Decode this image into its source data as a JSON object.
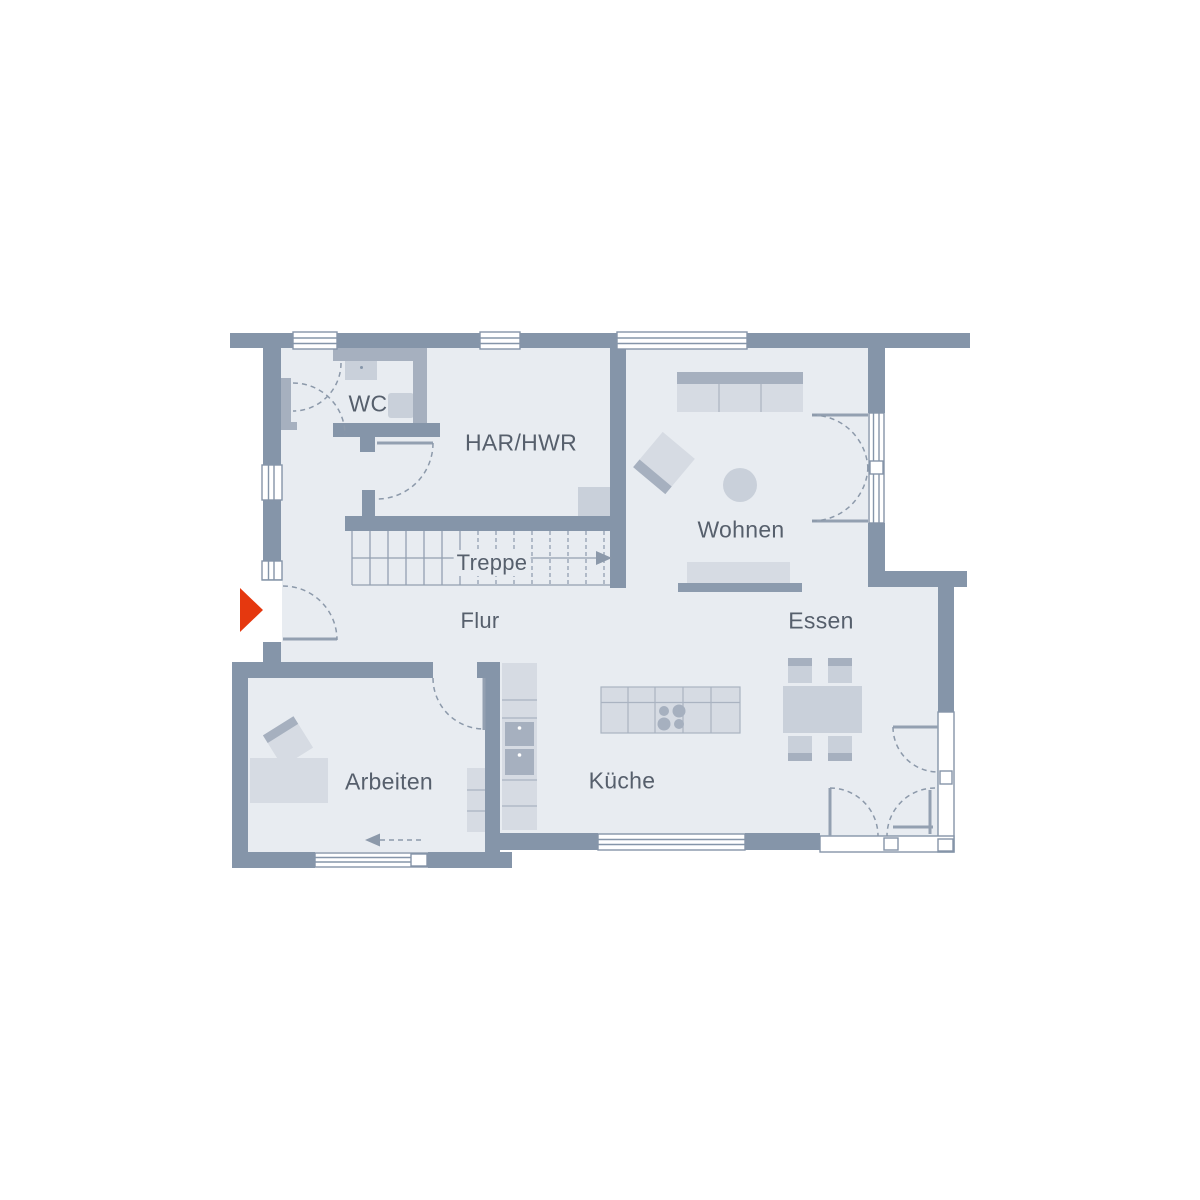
{
  "image": {
    "type": "floor-plan",
    "background": "#ffffff"
  },
  "rooms": [
    {
      "id": "wc",
      "label": "WC"
    },
    {
      "id": "har_hwr",
      "label": "HAR/HWR"
    },
    {
      "id": "treppe",
      "label": "Treppe"
    },
    {
      "id": "flur",
      "label": "Flur"
    },
    {
      "id": "wohnen",
      "label": "Wohnen"
    },
    {
      "id": "essen",
      "label": "Essen"
    },
    {
      "id": "arbeiten",
      "label": "Arbeiten"
    },
    {
      "id": "kueche",
      "label": "Küche"
    }
  ],
  "colors": {
    "wall": "#8595a9",
    "interior_wall": "#a6b0bf",
    "floor": "#e8ecf1",
    "furniture_light": "#d6dbe3",
    "furniture_mid": "#c9d0da",
    "furniture_dark": "#a6b0bf",
    "accent_red": "#e5380f",
    "label_text": "#565f6c"
  },
  "icons": {
    "entrance_arrow": "entrance-direction-arrow",
    "stair_arrow": "stair-run-arrow",
    "slide_arrow": "sliding-door-arrow"
  }
}
